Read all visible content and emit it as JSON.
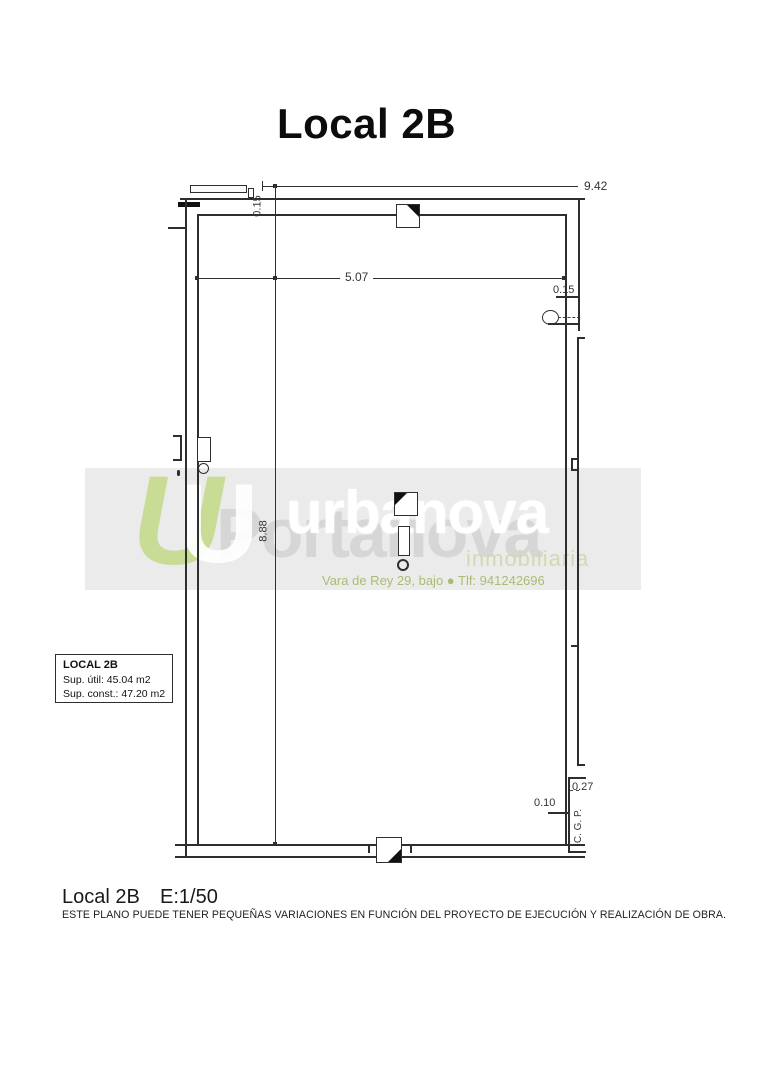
{
  "title": "Local 2B",
  "plan": {
    "dimensions": {
      "overall_width": "9.42",
      "wall_thickness_top": "0.15",
      "interior_width": "5.07",
      "wall_thickness_right": "0.15",
      "interior_length": "8.88",
      "cgp_depth": "0.27",
      "cgp_width": "0.10",
      "cgp_label": "C. G. P."
    },
    "info_box": {
      "title": "LOCAL 2B",
      "sup_util": "Sup. útil: 45.04 m2",
      "sup_const": "Sup. const.: 47.20 m2"
    },
    "line_color": "#2e2e2e"
  },
  "watermark": {
    "mark_glyph_back": "U",
    "mark_glyph_front": "U",
    "brand_back": "Portanova",
    "brand_front": "urbanova",
    "brand_sub": "inmobiliaria",
    "address": "Vara de Rey 29, bajo   ●   Tlf: 941242696",
    "colors": {
      "mark_green": "#c8dc96",
      "back_text": "#d6d6d6",
      "front_text": "#ffffff",
      "sub_text": "#d3d8b2",
      "address_text": "#a9bd72",
      "band_bg": "#e9e9e9"
    }
  },
  "footer": {
    "label": "Local 2B",
    "scale": "E:1/50",
    "disclaimer": "ESTE PLANO PUEDE TENER PEQUEÑAS VARIACIONES EN FUNCIÓN DEL PROYECTO DE EJECUCIÓN Y REALIZACIÓN DE OBRA."
  }
}
